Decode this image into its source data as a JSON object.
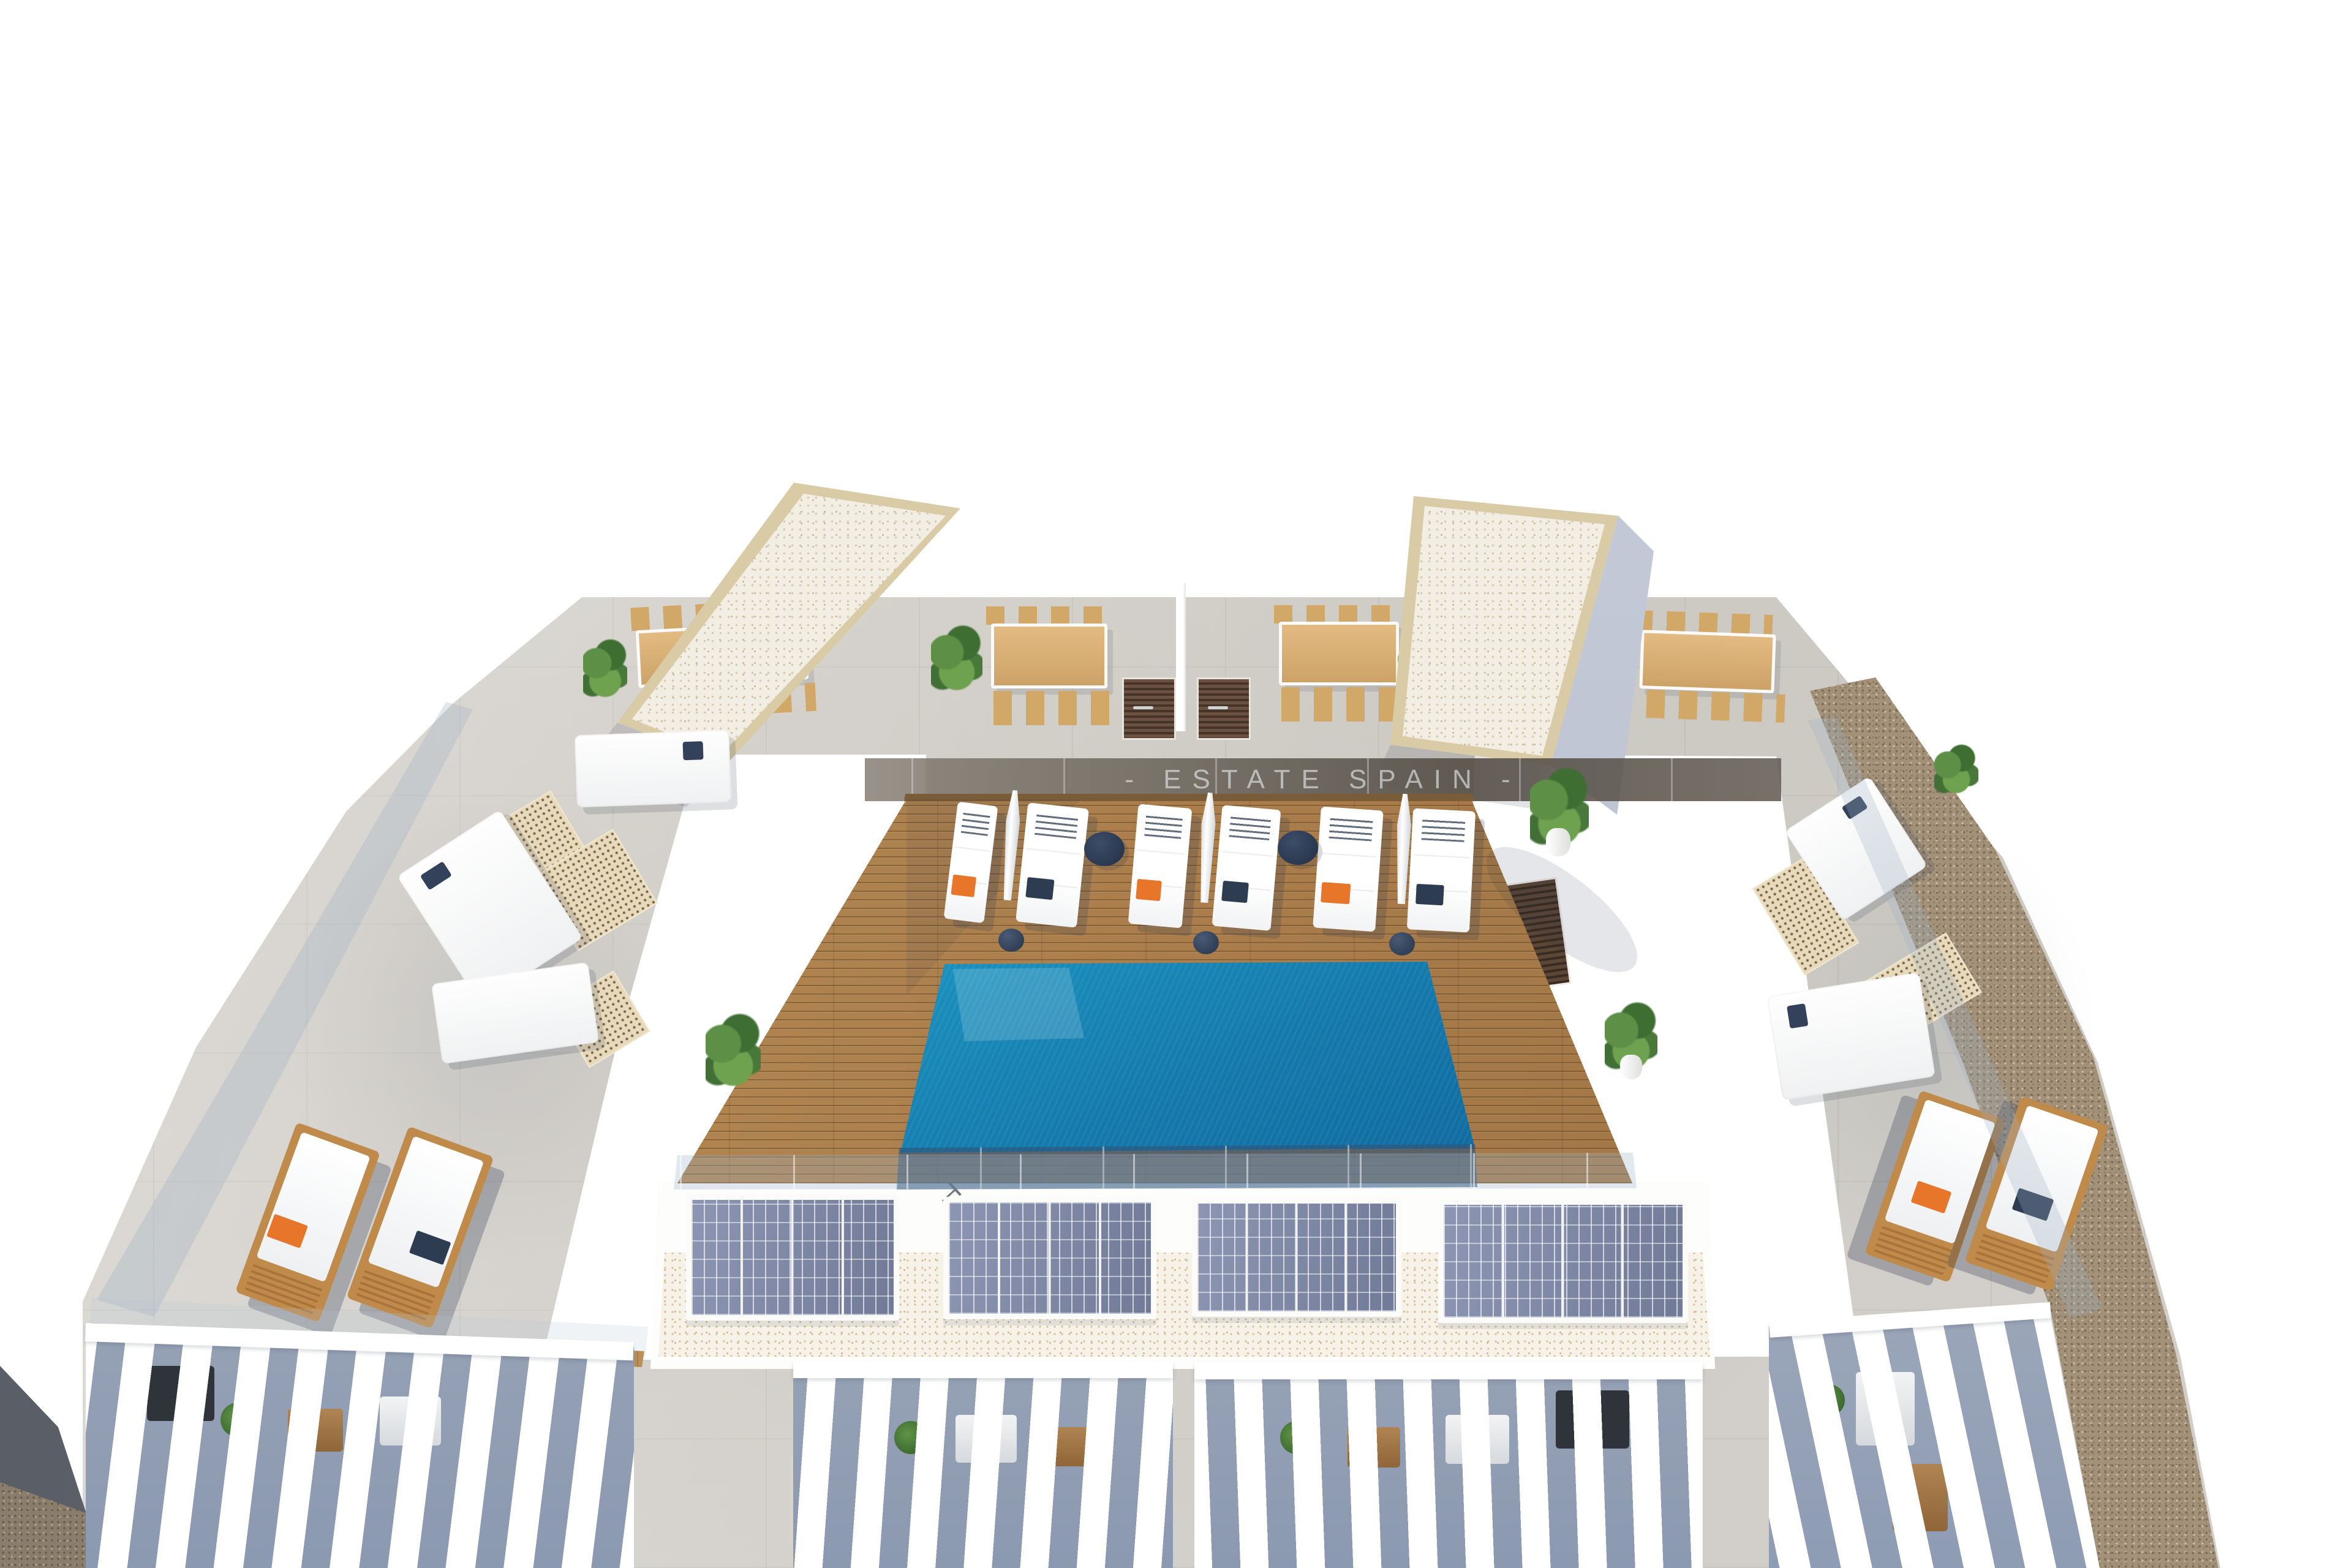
{
  "meta": {
    "title": "Rooftop terrace with infinity pool - aerial 3D architectural visualization",
    "type": "3d-render"
  },
  "watermark": {
    "text": "- ESTATE SPAIN -"
  },
  "scene": {
    "description": "Aerial view of a residential rooftop: central teak sun deck with infinity pool and white sun loungers, communal dining terraces with timber tables, two gravel-topped stair towers, side lounge terraces with white sofas, a row of solar panels, pergola-covered balconies along the lower edge and a pebble border on the right.",
    "counts": {
      "pools": 1,
      "deck_sun_loungers": 6,
      "closed_umbrellas": 3,
      "round_side_tables": 2,
      "dining_sets": 4,
      "louvered_doors": 2,
      "roof_towers": 2,
      "solar_panel_groups": 4,
      "panels_per_group": 4,
      "teak_loungers": 4,
      "sofa_pieces": 5,
      "floor_vent_mats": 5,
      "pergola_clusters": 4,
      "plants": 7
    }
  },
  "colors": {
    "background": "#ffffff",
    "pool_shallow": "#38c6e2",
    "pool_deep": "#0a4c85",
    "deck_wood": "#ad8150",
    "furniture_teak": "#c08a4a",
    "concrete": "#d9d6d0",
    "tower_gravel": "#f2eee3",
    "tower_border": "#d9cba6",
    "pebble_border": "#a39179",
    "accent_orange": "#e8762a",
    "accent_navy": "#2e3c52",
    "solar_panel": "#7f89a6",
    "greenery": "#5e8f46",
    "glass": "#9db4c6",
    "watermark_text": "#dde1e4"
  }
}
